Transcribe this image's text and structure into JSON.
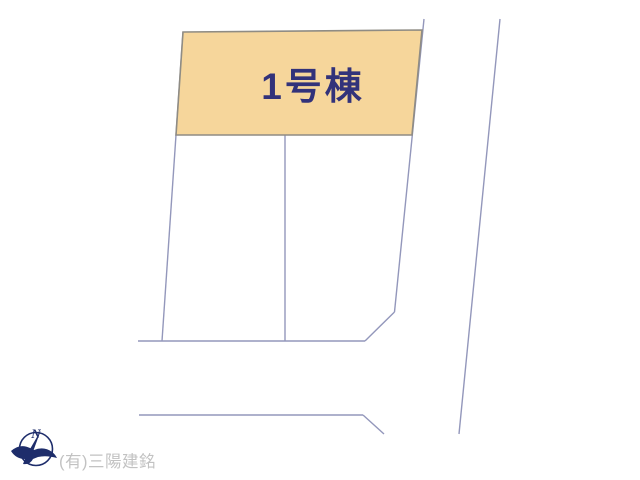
{
  "plan": {
    "building_label": "1号棟",
    "company_credit": "(有)三陽建銘",
    "compass_north_label": "N"
  },
  "colors": {
    "background": "#ffffff",
    "lot_highlight_fill": "#f6d69b",
    "lot_highlight_border": "#8f8c84",
    "boundary_line": "#9397bb",
    "building_label_text": "#32327a",
    "compass_navy": "#1e2d6b",
    "company_credit_text": "#c2c2c2"
  }
}
